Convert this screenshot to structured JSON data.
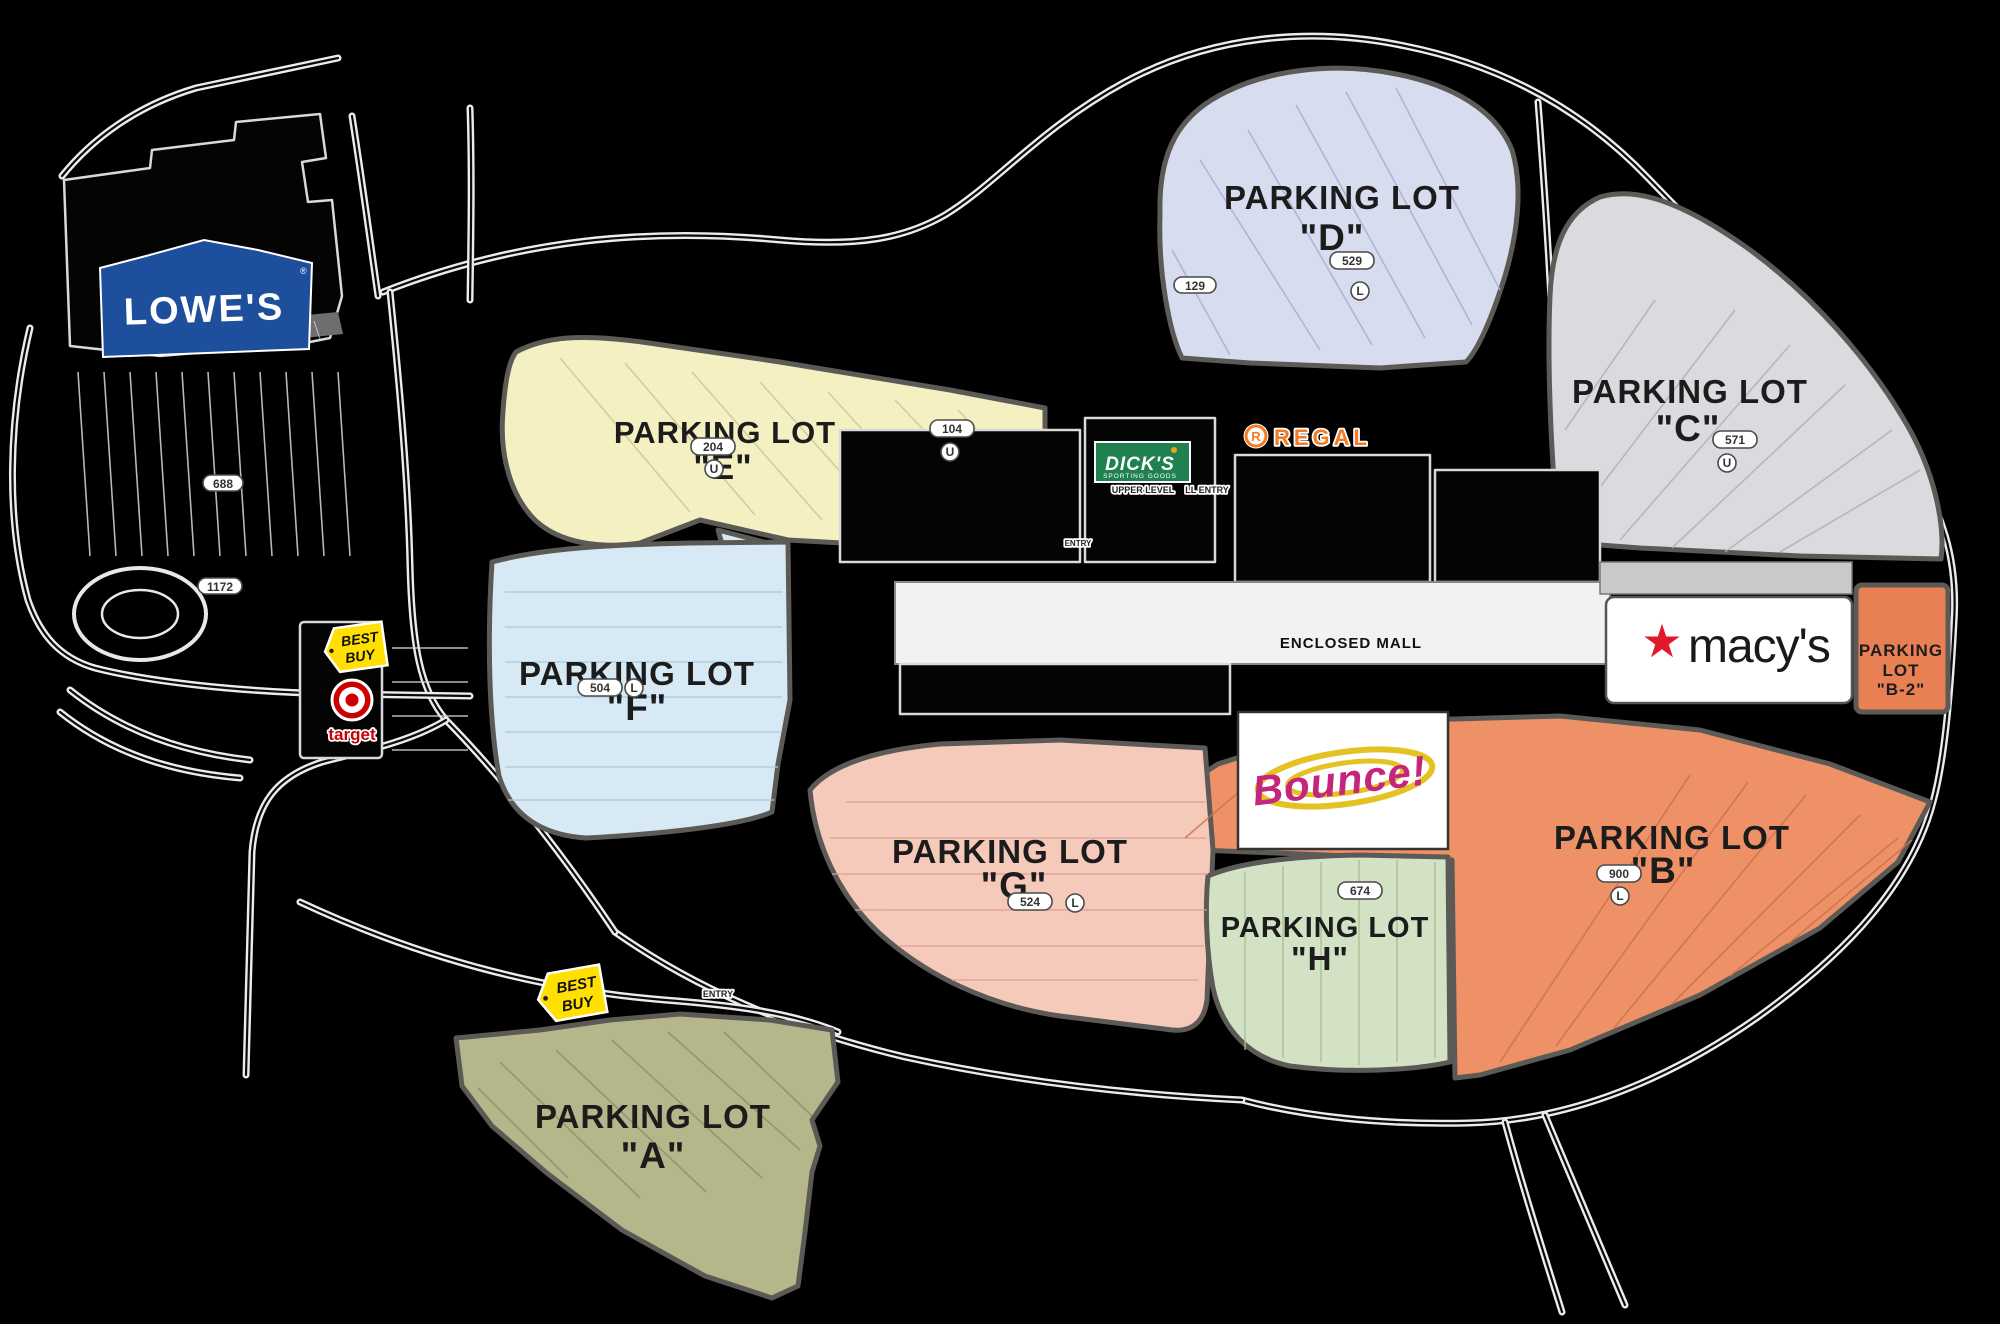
{
  "background": "#000000",
  "lots": [
    {
      "id": "d",
      "title": "PARKING LOT",
      "letter": "\"D\"",
      "color": "#d7dcee"
    },
    {
      "id": "c",
      "title": "PARKING LOT",
      "letter": "\"C\"",
      "color": "#dbdade"
    },
    {
      "id": "e",
      "title": "PARKING LOT",
      "letter": "\"E\"",
      "color": "#f4f0c2"
    },
    {
      "id": "f",
      "title": "PARKING LOT",
      "letter": "\"F\"",
      "color": "#d7e9f4"
    },
    {
      "id": "g",
      "title": "PARKING LOT",
      "letter": "\"G\"",
      "color": "#f5cabb"
    },
    {
      "id": "h",
      "title": "PARKING LOT",
      "letter": "\"H\"",
      "color": "#d3e2c5"
    },
    {
      "id": "b",
      "title": "PARKING LOT",
      "letter": "\"B\"",
      "color": "#ef9166"
    },
    {
      "id": "a",
      "title": "PARKING LOT",
      "letter": "\"A\"",
      "color": "#b5b78b"
    },
    {
      "id": "b2",
      "line1": "PARKING",
      "line2": "LOT",
      "line3": "\"B-2\"",
      "color": "#e88054"
    }
  ],
  "markers": {
    "d_count": "529",
    "d_level": "L",
    "d2_count": "129",
    "c_count": "571",
    "c_level": "U",
    "e_count": "104",
    "e_level": "U",
    "e2_count": "204",
    "e2_level": "U",
    "f_count": "504",
    "f_level": "L",
    "g_count": "524",
    "g_level": "L",
    "h_count": "674",
    "b_count": "900",
    "b_level": "L",
    "lowes_count": "688",
    "lowes2_count": "1172"
  },
  "labels": {
    "enclosed_mall": "ENCLOSED MALL",
    "upper_level": "UPPER LEVEL",
    "ll_entry": "LL ENTRY",
    "entry": "ENTRY"
  },
  "logos": {
    "lowes": {
      "text": "LOWE'S",
      "reg": "®",
      "bg": "#1d4f9c"
    },
    "best_buy": {
      "line1": "BEST",
      "line2": "BUY",
      "bg": "#ffe000"
    },
    "target": {
      "text": "target",
      "color": "#cc0000"
    },
    "dicks": {
      "name": "DICK'S",
      "sub": "SPORTING GOODS",
      "bg": "#1f8050"
    },
    "regal": {
      "r": "R",
      "text": "REGAL",
      "color": "#f47b20"
    },
    "macys": {
      "star": "★",
      "text": "macy's",
      "star_color": "#e01a2b"
    },
    "bounce": {
      "text": "Bounce!",
      "color": "#c4257d",
      "swirl": "#e3c222"
    }
  }
}
